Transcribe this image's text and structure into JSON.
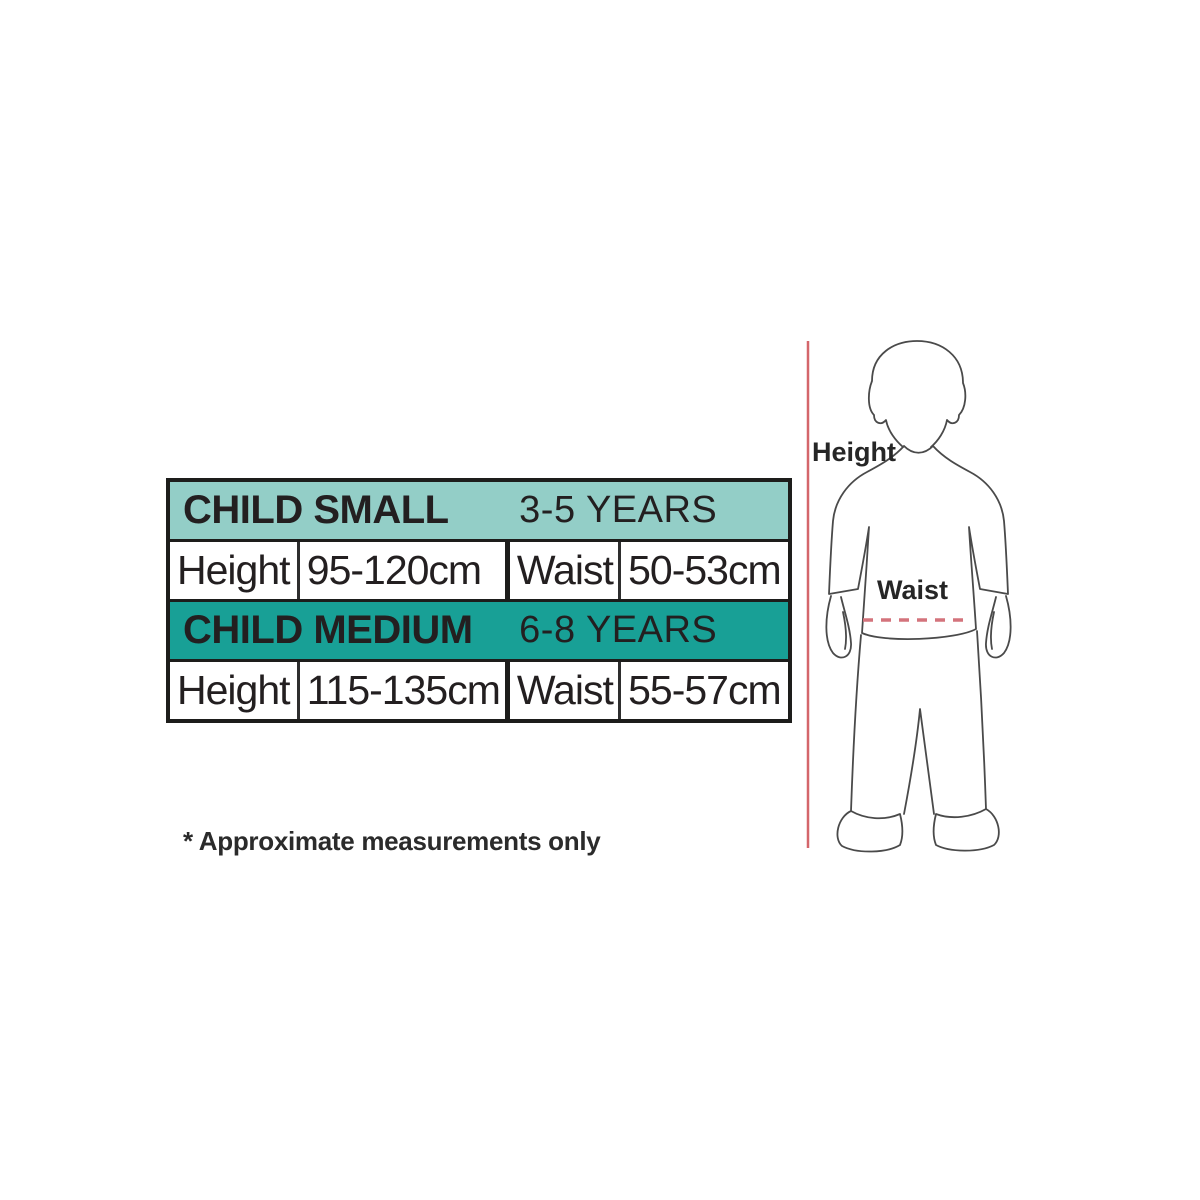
{
  "colors": {
    "header_small_bg": "#93cec7",
    "header_medium_bg": "#18a096",
    "table_border": "#1d1d1b",
    "text": "#231f20",
    "figure_outline": "#4a4a4a",
    "height_line": "#d4666b",
    "waist_dash": "#d4737c"
  },
  "size_chart": {
    "sections": [
      {
        "name": "CHILD SMALL",
        "age_range": "3-5 YEARS",
        "rows": [
          {
            "label": "Height",
            "value": "95-120cm"
          },
          {
            "label": "Waist",
            "value": "50-53cm"
          }
        ]
      },
      {
        "name": "CHILD MEDIUM",
        "age_range": "6-8 YEARS",
        "rows": [
          {
            "label": "Height",
            "value": "115-135cm"
          },
          {
            "label": "Waist",
            "value": "55-57cm"
          }
        ]
      }
    ]
  },
  "footnote": "* Approximate measurements only",
  "figure": {
    "height_label": "Height",
    "waist_label": "Waist"
  }
}
